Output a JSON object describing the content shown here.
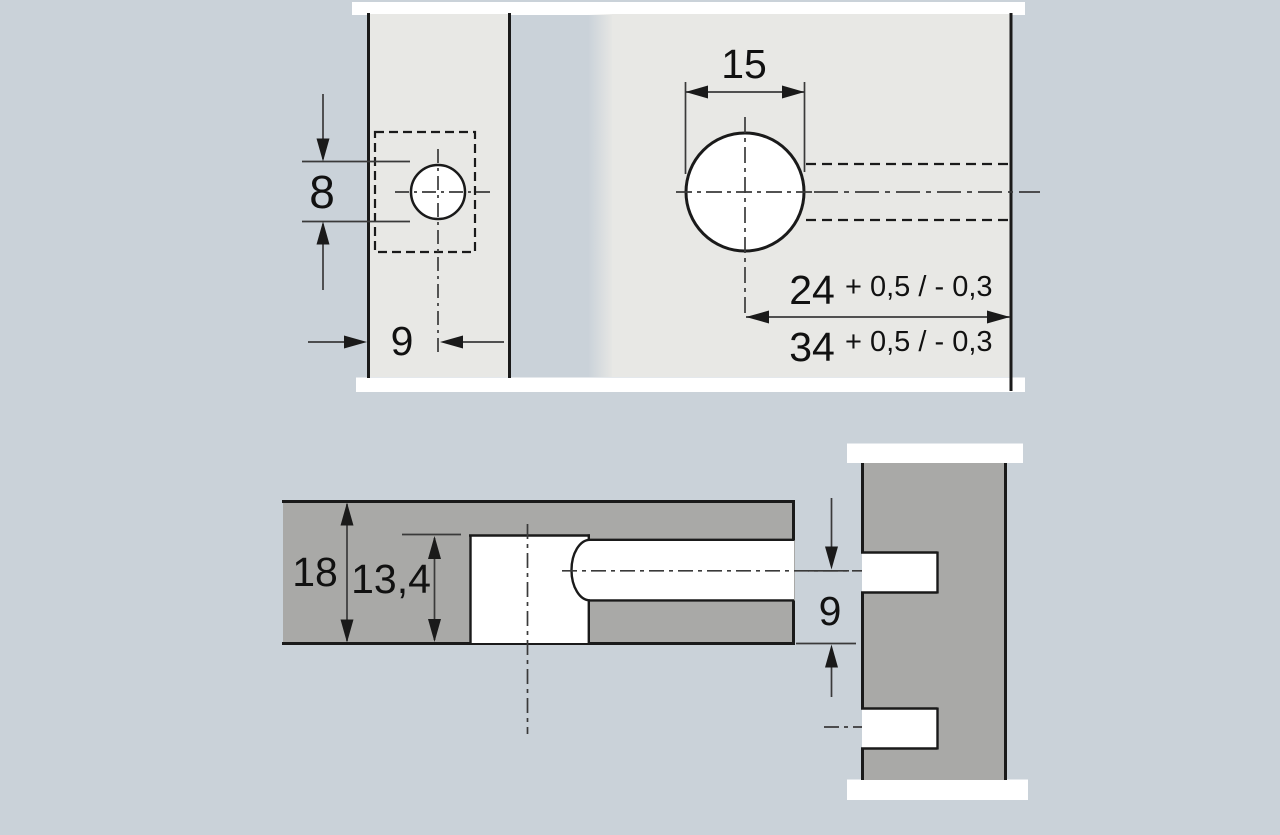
{
  "labels": {
    "small_hole_diameter": "8",
    "small_hole_edge_distance": "9",
    "large_hole_diameter": "15",
    "distance_24": "24",
    "distance_24_tolerance": "+ 0,5 / - 0,3",
    "distance_34": "34",
    "distance_34_tolerance": "+ 0,5 / - 0,3",
    "panel_thickness": "18",
    "bore_depth": "13,4",
    "axis_edge_distance": "9"
  },
  "colors": {
    "background": "#cad2d9",
    "panel-light": "#e8e8e5",
    "panel-dark": "#a9a9a7",
    "outline": "#1a1a1a",
    "dimension-line": "#3a3a3a",
    "text": "#111111",
    "white": "#ffffff"
  }
}
